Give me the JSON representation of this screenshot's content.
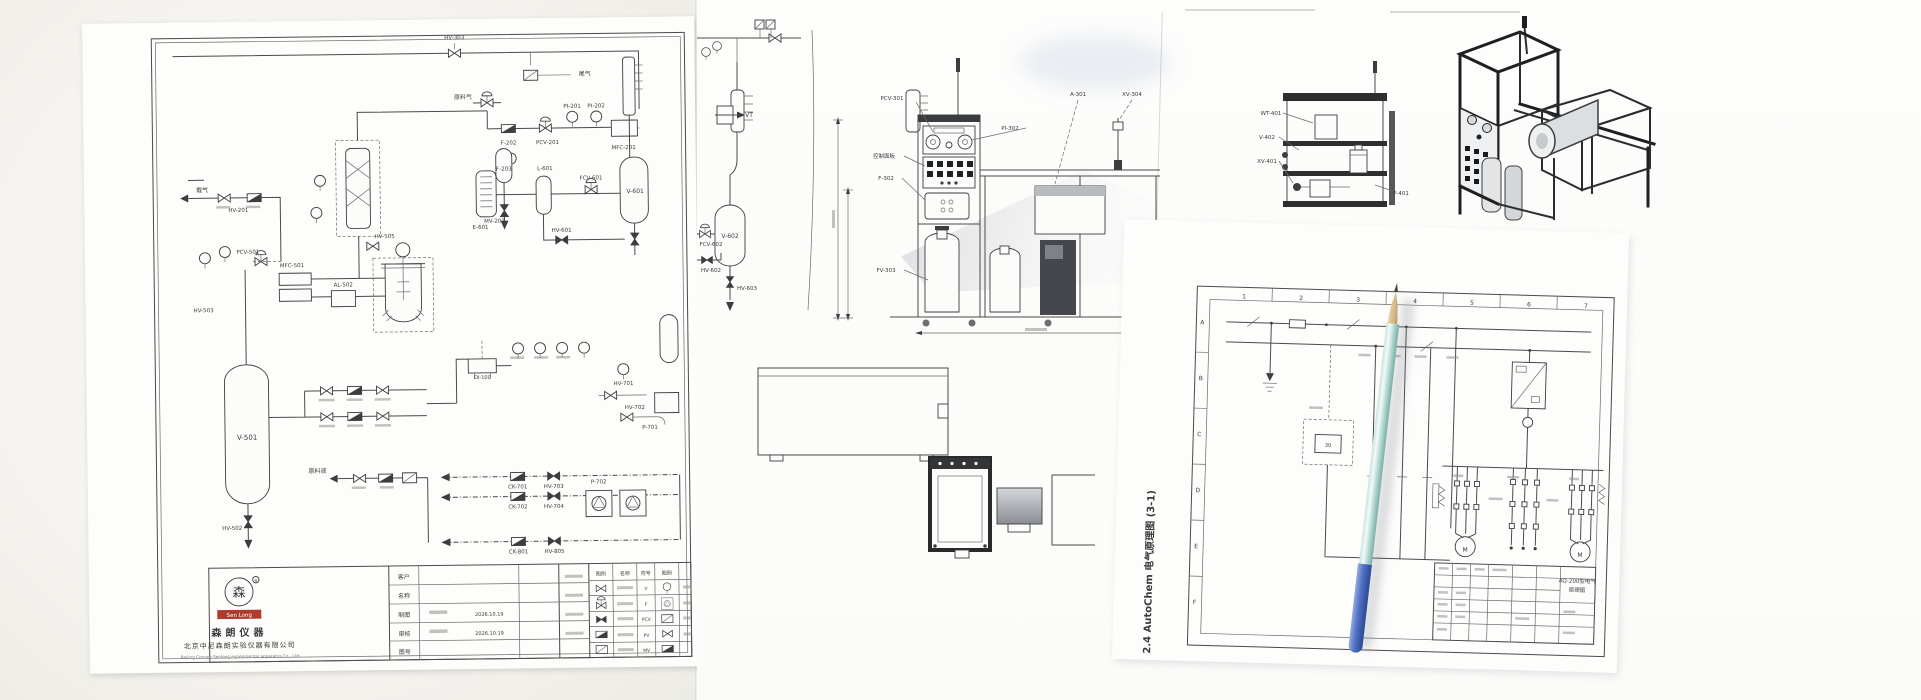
{
  "pid_sheet": {
    "logo_text": "Sen Long",
    "logo_mark": "森",
    "logo_reg": "R",
    "company_cn": "森朗仪器",
    "company_line_cn": "北京中尼森朗实验仪器有限公司",
    "company_en": "Beijing Censen Senlong experimental apparatus Co., Ltd",
    "fields": [
      {
        "label": "客户",
        "value": ""
      },
      {
        "label": "名称",
        "value": ""
      },
      {
        "label": "制图",
        "value": "2026.10.19"
      },
      {
        "label": "审核",
        "value": "2026.10.19"
      },
      {
        "label": "图号",
        "value": ""
      }
    ],
    "legend": {
      "headers": [
        "图例",
        "名称",
        "符号"
      ],
      "codes": [
        "V",
        "F",
        "PCV",
        "PV",
        "MV"
      ]
    }
  },
  "electrical": {
    "caption": "2.4 AutoChem 电气原理图 (3-1)"
  },
  "labels": {
    "pid": [
      {
        "t": "HV-303",
        "x": 372,
        "y": 20
      },
      {
        "t": "尾气",
        "x": 502,
        "y": 58,
        "fs": 6
      },
      {
        "t": "原料气",
        "x": 380,
        "y": 80,
        "fs": 6
      },
      {
        "t": "载气",
        "x": 118,
        "y": 170,
        "fs": 6
      },
      {
        "t": "F-202",
        "x": 425,
        "y": 126
      },
      {
        "t": "PCV-201",
        "x": 464,
        "y": 126
      },
      {
        "t": "PI-201",
        "x": 489,
        "y": 90
      },
      {
        "t": "PI-202",
        "x": 513,
        "y": 90
      },
      {
        "t": "MFC-201",
        "x": 540,
        "y": 132
      },
      {
        "t": "F-203",
        "x": 420,
        "y": 152
      },
      {
        "t": "MV-202",
        "x": 410,
        "y": 204
      },
      {
        "t": "HV-201",
        "x": 154,
        "y": 190
      },
      {
        "t": "V-601",
        "x": 551,
        "y": 176,
        "fs": 6
      },
      {
        "t": "E-601",
        "x": 396,
        "y": 210
      },
      {
        "t": "L-601",
        "x": 461,
        "y": 152
      },
      {
        "t": "FCV-601",
        "x": 507,
        "y": 162
      },
      {
        "t": "HV-601",
        "x": 477,
        "y": 214
      },
      {
        "t": "HV-505",
        "x": 300,
        "y": 218
      },
      {
        "t": "PCV-501",
        "x": 163,
        "y": 232
      },
      {
        "t": "MFC-501",
        "x": 207,
        "y": 246
      },
      {
        "t": "AL-502",
        "x": 258,
        "y": 266
      },
      {
        "t": "HV-503",
        "x": 118,
        "y": 290
      },
      {
        "t": "V-501",
        "x": 160,
        "y": 418,
        "fs": 7
      },
      {
        "t": "HV-502",
        "x": 144,
        "y": 508
      },
      {
        "t": "原料液",
        "x": 230,
        "y": 452,
        "fs": 6
      },
      {
        "t": "CK-701",
        "x": 430,
        "y": 470
      },
      {
        "t": "HV-703",
        "x": 466,
        "y": 470
      },
      {
        "t": "CK-702",
        "x": 430,
        "y": 490
      },
      {
        "t": "HV-704",
        "x": 466,
        "y": 490
      },
      {
        "t": "P-702",
        "x": 511,
        "y": 466
      },
      {
        "t": "CK-801",
        "x": 430,
        "y": 535
      },
      {
        "t": "HV-805",
        "x": 466,
        "y": 535
      },
      {
        "t": "HV-701",
        "x": 537,
        "y": 368
      },
      {
        "t": "HV-702",
        "x": 548,
        "y": 392
      },
      {
        "t": "P-701",
        "x": 563,
        "y": 412
      },
      {
        "t": "DI-100",
        "x": 396,
        "y": 360,
        "fs": 5
      }
    ],
    "frag": [
      {
        "t": "VT",
        "x": 52,
        "y": 107,
        "fs": 6
      },
      {
        "t": "V-602",
        "x": 33,
        "y": 228,
        "fs": 6
      },
      {
        "t": "FCV-602",
        "x": 14,
        "y": 236
      },
      {
        "t": "HV-602",
        "x": 14,
        "y": 262
      },
      {
        "t": "HV-603",
        "x": 50,
        "y": 280
      }
    ],
    "elev": [
      {
        "t": "PCV-301",
        "x": 62,
        "y": 60
      },
      {
        "t": "PI-302",
        "x": 180,
        "y": 90
      },
      {
        "t": "控制面板",
        "x": 54,
        "y": 118
      },
      {
        "t": "F-302",
        "x": 56,
        "y": 140
      },
      {
        "t": "FV-303",
        "x": 56,
        "y": 232
      },
      {
        "t": "A-301",
        "x": 248,
        "y": 56
      },
      {
        "t": "XV-304",
        "x": 302,
        "y": 56
      }
    ],
    "side": [
      {
        "t": "WT-401",
        "x": 16,
        "y": 60
      },
      {
        "t": "V-402",
        "x": 12,
        "y": 84
      },
      {
        "t": "XV-401",
        "x": 12,
        "y": 108
      },
      {
        "t": "P-401",
        "x": 146,
        "y": 140
      }
    ],
    "elec": [
      {
        "t": "1",
        "x": 122,
        "y": 76,
        "fs": 6
      },
      {
        "t": "2",
        "x": 179,
        "y": 76,
        "fs": 6
      },
      {
        "t": "3",
        "x": 236,
        "y": 76,
        "fs": 6
      },
      {
        "t": "4",
        "x": 293,
        "y": 76,
        "fs": 6
      },
      {
        "t": "5",
        "x": 350,
        "y": 76,
        "fs": 6
      },
      {
        "t": "6",
        "x": 407,
        "y": 76,
        "fs": 6
      },
      {
        "t": "7",
        "x": 464,
        "y": 76,
        "fs": 6
      },
      {
        "t": "A",
        "x": 81,
        "y": 103,
        "fs": 6
      },
      {
        "t": "B",
        "x": 81,
        "y": 159,
        "fs": 6
      },
      {
        "t": "C",
        "x": 81,
        "y": 215,
        "fs": 6
      },
      {
        "t": "D",
        "x": 81,
        "y": 271,
        "fs": 6
      },
      {
        "t": "E",
        "x": 81,
        "y": 327,
        "fs": 6
      },
      {
        "t": "F",
        "x": 81,
        "y": 383,
        "fs": 6
      },
      {
        "t": "30",
        "x": 210,
        "y": 222,
        "fs": 5
      },
      {
        "t": "M",
        "x": 350,
        "y": 323,
        "fs": 6
      },
      {
        "t": "M",
        "x": 465,
        "y": 325,
        "fs": 6
      },
      {
        "t": "AQ-200型电气",
        "x": 463,
        "y": 351,
        "fs": 5.5
      },
      {
        "t": "原理图",
        "x": 463,
        "y": 360,
        "fs": 5.5
      },
      {
        "t": "2.4 AutoChem 电气原理图 (3-1)",
        "x": 38,
        "y": 352,
        "rot": -90,
        "fs": 10,
        "b": 1
      }
    ]
  }
}
